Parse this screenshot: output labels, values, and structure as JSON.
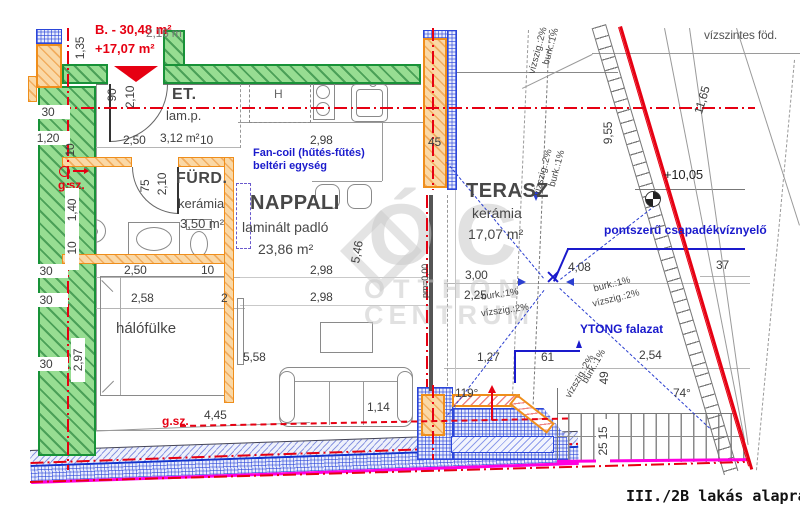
{
  "title": "III./2B lakás alaprajz",
  "watermark": {
    "logo_text": "ÓC",
    "line1": "OTTHON",
    "line2": "CENTRUM"
  },
  "red_labels": {
    "area_main": "B. - 30,48 m²",
    "area_terrace": "+17,07 m²",
    "gsz_1": "g.sz.",
    "gsz_2": "g.sz."
  },
  "rooms": {
    "et": {
      "name": "ET.",
      "floor": "lam.p.",
      "area": "3,12 m²"
    },
    "furdo": {
      "name": "FÜRD.",
      "floor": "kerámia",
      "area": "3,50 m²"
    },
    "nappali": {
      "name": "NAPPALI",
      "floor": "laminált padló",
      "area": "23,86 m²"
    },
    "halofulke": {
      "name": "hálófülke"
    },
    "terasz": {
      "name": "TERASZ",
      "floor": "kerámia",
      "area": "17,07 m²"
    }
  },
  "annotations": {
    "fan_coil_line1": "Fan-coil (hűtés-fűtés)",
    "fan_coil_line2": "beltéri egység",
    "drain_label": "pontszerű csapadékvíznyelő",
    "ytong_label": "YTONG falazat",
    "slab_label": "vízszintes föd.",
    "level_value": "+10,05",
    "hob_symbol": "H",
    "parapet_mark": "pm=0,00"
  },
  "dimensions": [
    "1,35",
    "2,16 m",
    "90",
    "2,10",
    "2,50",
    "3,12 m²",
    "10",
    "30",
    "1,20",
    "10",
    "75",
    "2,10",
    "1,40",
    "10",
    "2,50",
    "10",
    "2,58",
    "2",
    "2,97",
    "30",
    "30",
    "30",
    "5,58",
    "2,98",
    "2,98",
    "2,98",
    "5,46",
    "1,14",
    "4,45",
    "45",
    "3,00",
    "4,08",
    "2,25",
    "1,27",
    "61",
    "2,54",
    "49",
    "119°",
    "74°",
    "37",
    "9,55",
    "11,65",
    "25 15"
  ],
  "slope_labels": [
    "burk.:1%",
    "vízszig.:2%",
    "burk.:1%",
    "vízszig.:2%",
    "burk.:1%",
    "vízszig.:2%",
    "burk.:1%",
    "vízszig.:2%",
    "burk.:1%",
    "vízszig.:2%"
  ],
  "colors": {
    "existing_wall_green": "#189238",
    "new_wall_orange": "#ef8e1b",
    "insulation_blue": "#2b46d9",
    "axis_red": "#e60012",
    "utility_magenta": "#ff00e0",
    "annotation_blue": "#1a1acc"
  }
}
